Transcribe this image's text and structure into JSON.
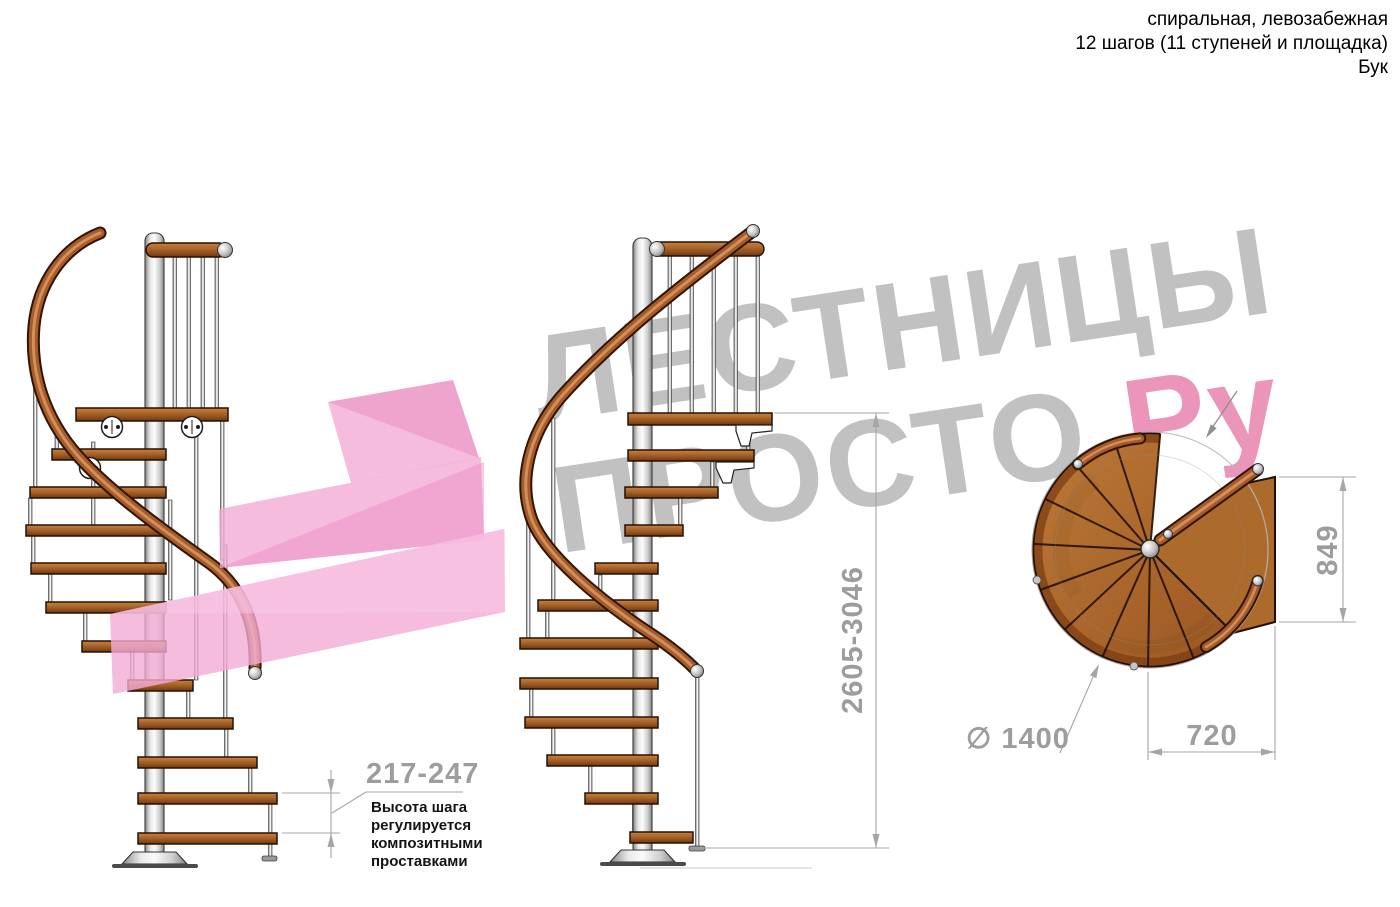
{
  "header": {
    "line1": "спиральная, левозабежная",
    "line2": "12 шагов (11 ступеней и площадка)",
    "line3": "Бук"
  },
  "watermark": {
    "word1": "ЛЕСТНИЦЫ",
    "word2": "ПРОСТО",
    "word2_suffix": ".Ру"
  },
  "dims": {
    "step_height": "217-247",
    "note_line1": "Высота шага",
    "note_line2": "регулируется",
    "note_line3": "композитными",
    "note_line4": "проставками",
    "total_height": "2605-3046",
    "landing_depth": "849",
    "landing_width": "720",
    "diameter": "∅ 1400"
  },
  "colors": {
    "wood": "#a96230",
    "metal": "#d9d9d9",
    "dim_gray": "#9d9d9d",
    "watermark_gray": "#969696",
    "watermark_pink": "#e0498b",
    "arrow_pink": "#f2abd4"
  }
}
